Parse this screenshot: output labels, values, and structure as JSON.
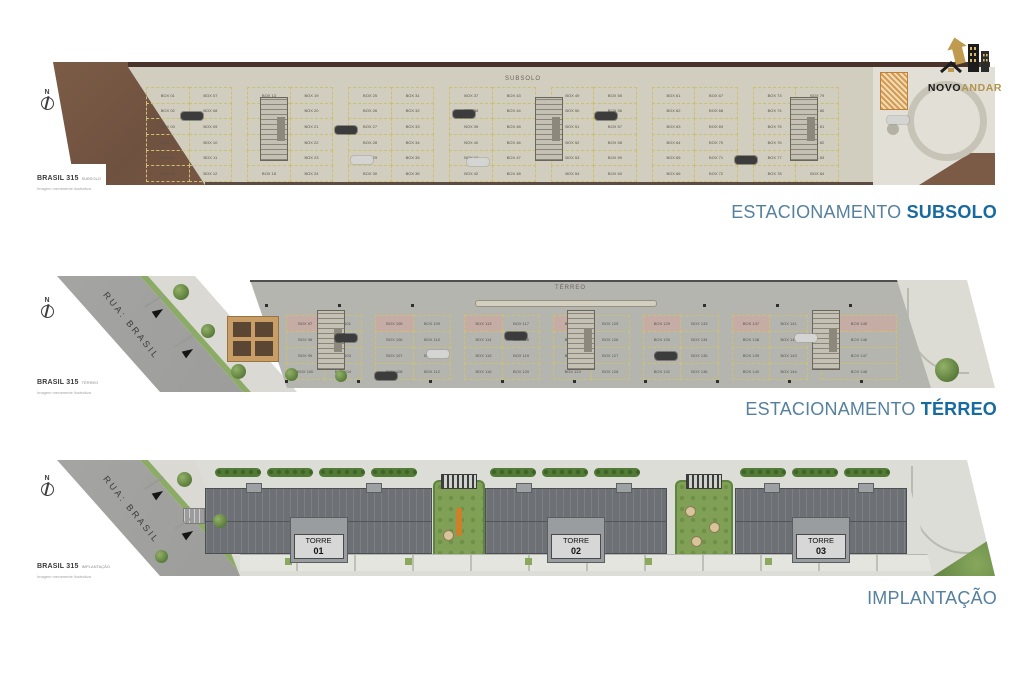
{
  "compass": "N",
  "logo": {
    "name_primary": "NOVO",
    "name_secondary": "ANDAR",
    "primary_color": "#1a1a1a",
    "secondary_color": "#b3924c"
  },
  "captions": {
    "subsolo": {
      "regular": "ESTACIONAMENTO",
      "bold": "SUBSOLO"
    },
    "terreo": {
      "regular": "ESTACIONAMENTO",
      "bold": "TÉRREO"
    },
    "implantacao": {
      "regular": "IMPLANTAÇÃO"
    }
  },
  "colors": {
    "caption_light_blue": "#55819f",
    "caption_dark_blue": "#176aa0",
    "logo_gold": "#b3924c",
    "dirt_brown": "#7b5b45",
    "subsolo_floor": "#d1cdbf",
    "terreo_floor": "#b5b5b0",
    "street_gray": "#a0a09e",
    "landscape_green": "#7fa055",
    "roof_gray": "#6d7175",
    "parking_line_yellow": "#cdbf74"
  },
  "plans": {
    "subsolo": {
      "map_label": "SUBSOLO",
      "footer_title": "BRASIL 315",
      "footer_sub": "SUBSOLO",
      "footer_note": "Imagem meramente ilustrativa",
      "boxes": [
        "BOX 01",
        "BOX 02",
        "BOX 03",
        "BOX 04",
        "BOX 05",
        "BOX 06",
        "BOX 07",
        "BOX 08",
        "BOX 09",
        "BOX 10",
        "BOX 11",
        "BOX 12",
        "BOX 13",
        "BOX 14",
        "BOX 15",
        "BOX 16",
        "BOX 17",
        "BOX 18",
        "BOX 19",
        "BOX 20",
        "BOX 21",
        "BOX 22",
        "BOX 23",
        "BOX 24",
        "BOX 25",
        "BOX 26",
        "BOX 27",
        "BOX 28",
        "BOX 29",
        "BOX 30",
        "BOX 31",
        "BOX 32",
        "BOX 33",
        "BOX 34",
        "BOX 35",
        "BOX 36",
        "BOX 37",
        "BOX 38",
        "BOX 39",
        "BOX 40",
        "BOX 41",
        "BOX 42",
        "BOX 43",
        "BOX 44",
        "BOX 45",
        "BOX 46",
        "BOX 47",
        "BOX 48",
        "BOX 49",
        "BOX 50",
        "BOX 51",
        "BOX 52",
        "BOX 53",
        "BOX 54",
        "BOX 55",
        "BOX 56",
        "BOX 57",
        "BOX 58",
        "BOX 59",
        "BOX 60",
        "BOX 61",
        "BOX 62",
        "BOX 63",
        "BOX 64",
        "BOX 65",
        "BOX 66",
        "BOX 67",
        "BOX 68",
        "BOX 69",
        "BOX 70",
        "BOX 71",
        "BOX 72",
        "BOX 73",
        "BOX 74",
        "BOX 75",
        "BOX 76",
        "BOX 77",
        "BOX 78",
        "BOX 79",
        "BOX 80",
        "BOX 81",
        "BOX 82",
        "BOX 83",
        "BOX 84"
      ]
    },
    "terreo": {
      "map_label": "TÉRREO",
      "street_name": "RUA: BRASIL",
      "footer_title": "BRASIL 315",
      "footer_sub": "TÉRREO",
      "footer_note": "Imagem meramente ilustrativa",
      "boxes": [
        "BOX 97",
        "BOX 98",
        "BOX 99",
        "BOX 100",
        "BOX 101",
        "BOX 102",
        "BOX 103",
        "BOX 104",
        "BOX 105",
        "BOX 106",
        "BOX 107",
        "BOX 108",
        "BOX 109",
        "BOX 110",
        "BOX 111",
        "BOX 112",
        "BOX 113",
        "BOX 114",
        "BOX 115",
        "BOX 116",
        "BOX 117",
        "BOX 118",
        "BOX 119",
        "BOX 120",
        "BOX 121",
        "BOX 122",
        "BOX 123",
        "BOX 124",
        "BOX 125",
        "BOX 126",
        "BOX 127",
        "BOX 128",
        "BOX 129",
        "BOX 130",
        "BOX 131",
        "BOX 132",
        "BOX 133",
        "BOX 134",
        "BOX 135",
        "BOX 136",
        "BOX 137",
        "BOX 138",
        "BOX 139",
        "BOX 140",
        "BOX 141",
        "BOX 142",
        "BOX 143",
        "BOX 144",
        "BOX 145",
        "BOX 146",
        "BOX 147",
        "BOX 148"
      ]
    },
    "implantacao": {
      "street_name": "RUA: BRASIL",
      "footer_title": "BRASIL 315",
      "footer_sub": "IMPLANTAÇÃO",
      "footer_note": "Imagem meramente ilustrativa",
      "towers": [
        {
          "label": "TORRE",
          "number": "01"
        },
        {
          "label": "TORRE",
          "number": "02"
        },
        {
          "label": "TORRE",
          "number": "03"
        }
      ]
    }
  }
}
